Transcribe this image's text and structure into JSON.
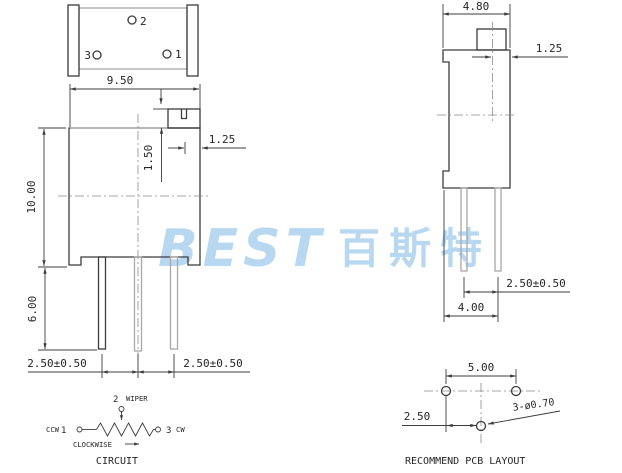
{
  "colors": {
    "line": "#3c3c3c",
    "watermark": "#b7d8f0"
  },
  "watermark": {
    "latin": "BEST",
    "cjk": "百斯特"
  },
  "top_view": {
    "pin1_label": "1",
    "pin2_label": "2",
    "pin3_label": "3",
    "dim_width": "9.50"
  },
  "front_view": {
    "dim_height": "10.00",
    "dim_pin_length": "6.00",
    "dim_screw_inset": "1.50",
    "dim_slot_offset": "1.25",
    "dim_pitch_left": "2.50±0.50",
    "dim_pitch_right": "2.50±0.50"
  },
  "side_view": {
    "dim_width": "4.80",
    "dim_slot_offset": "1.25",
    "dim_pin_pitch": "2.50±0.50",
    "dim_base": "4.00"
  },
  "circuit": {
    "pin2_label": "2",
    "wiper_label": "WIPER",
    "ccw_label": "CCW",
    "pin1_label": "1",
    "pin3_label": "3",
    "cw_label": "CW",
    "direction_label": "CLOCKWISE",
    "title": "CIRCUIT"
  },
  "pcb_layout": {
    "dim_hole_pitch": "5.00",
    "dim_row_offset": "2.50",
    "dim_hole_size": "3-ø0.70",
    "title": "RECOMMEND PCB LAYOUT"
  }
}
